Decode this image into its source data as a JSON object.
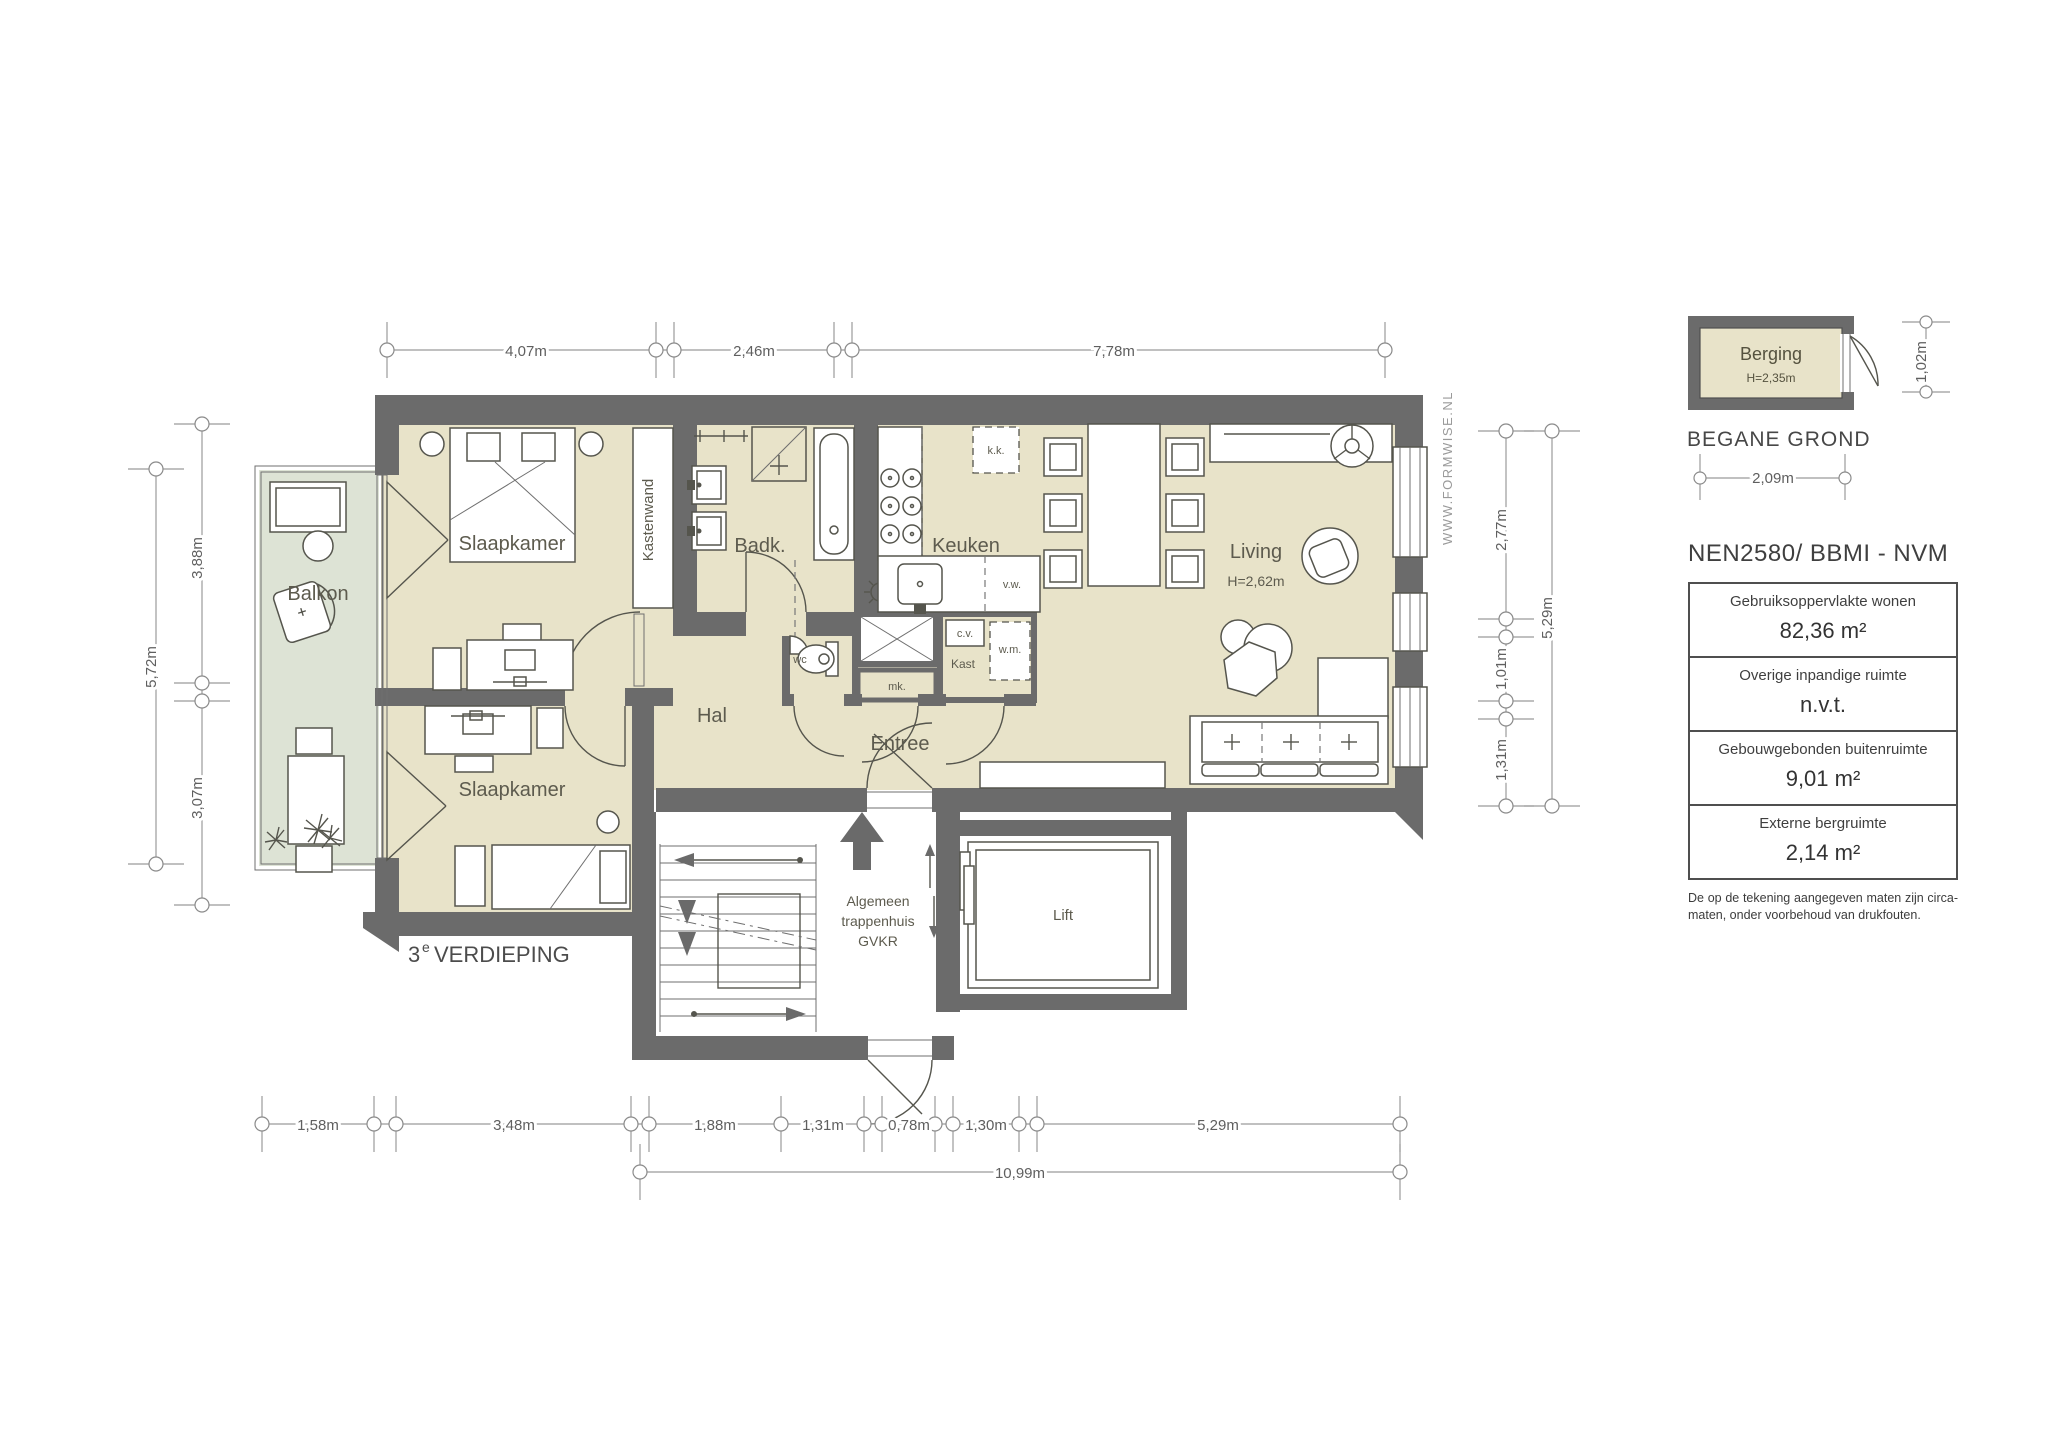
{
  "colors": {
    "wall": "#6b6b6b",
    "floor": "#e8e3c9",
    "balcony": "#dde3d5",
    "line": "#55554d",
    "dimline": "#9b9b9b",
    "dimtext": "#5f5f5f",
    "label": "#5d5b4e",
    "panel_text": "#474747"
  },
  "plan": {
    "floor_label": {
      "number": "3",
      "sup": "e",
      "text": "VERDIEPING"
    },
    "watermark": "WWW.FORMWISE.NL",
    "rooms": {
      "balkon": "Balkon",
      "slaapkamer_1": "Slaapkamer",
      "slaapkamer_2": "Slaapkamer",
      "kastenwand": "Kastenwand",
      "badkamer": "Badk.",
      "keuken": "Keuken",
      "living": "Living",
      "living_height": "H=2,62m",
      "hal": "Hal",
      "entree": "Entree",
      "wc": "wc",
      "meterkast": "mk.",
      "kast": "Kast",
      "cv": "c.v.",
      "wasmachine": "w.m.",
      "vaatwasser": "v.w.",
      "koelkast": "k.k.",
      "lift": "Lift",
      "trappenhuis_line1": "Algemeen",
      "trappenhuis_line2": "trappenhuis",
      "trappenhuis_line3": "GVKR"
    },
    "dimensions": {
      "top": [
        "4,07m",
        "2,46m",
        "7,78m"
      ],
      "left": [
        "3,88m",
        "5,72m",
        "3,07m"
      ],
      "right": [
        "2,77m",
        "1,01m",
        "1,31m",
        "5,29m"
      ],
      "bottom": [
        "1,58m",
        "3,48m",
        "1,88m",
        "1,31m",
        "0,78m",
        "1,30m",
        "5,29m"
      ],
      "bottom_total": "10,99m"
    }
  },
  "legend": {
    "berging": {
      "name": "Berging",
      "height": "H=2,35m",
      "caption": "BEGANE GROND",
      "width_dim": "2,09m",
      "depth_dim": "1,02m"
    },
    "norm_title": "NEN2580/ BBMI - NVM",
    "area_table": [
      {
        "label": "Gebruiksoppervlakte wonen",
        "value": "82,36 m²"
      },
      {
        "label": "Overige inpandige ruimte",
        "value": "n.v.t."
      },
      {
        "label": "Gebouwgebonden buitenruimte",
        "value": "9,01 m²"
      },
      {
        "label": "Externe bergruimte",
        "value": "2,14 m²"
      }
    ],
    "disclaimer": "De op de tekening aangegeven maten zijn circa-maten, onder voorbehoud van drukfouten."
  }
}
